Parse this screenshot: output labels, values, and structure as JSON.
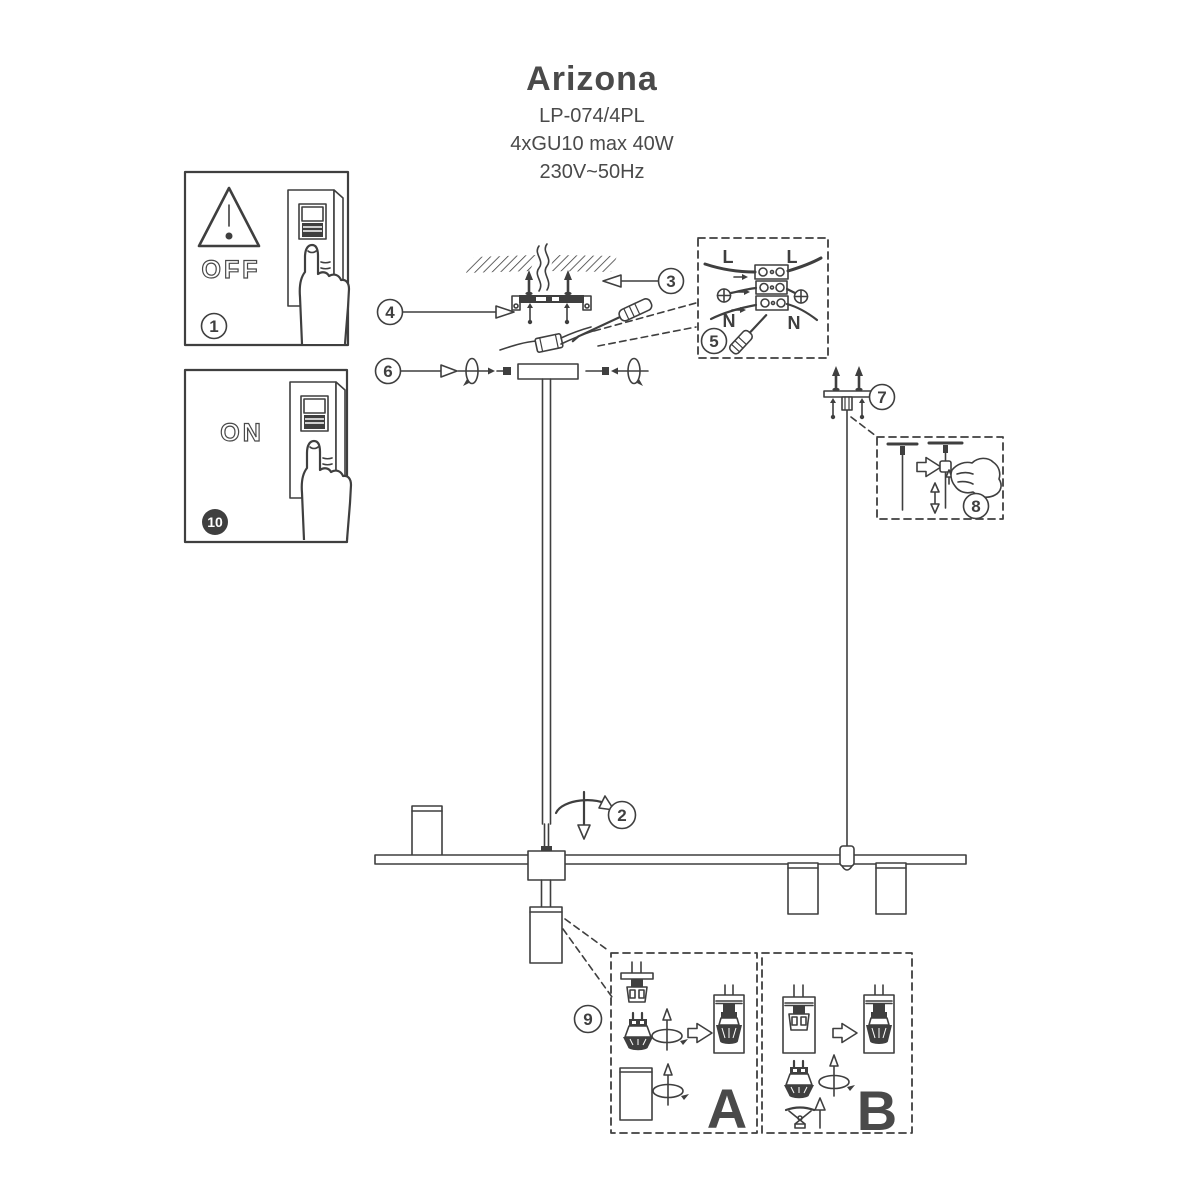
{
  "meta": {
    "ink_color": "#3f3f3f",
    "paper_color": "#ffffff"
  },
  "title": {
    "product": "Arizona",
    "model": "LP-074/4PL",
    "lamps": "4xGU10 max 40W",
    "voltage": "230V~50Hz"
  },
  "switch_panels": {
    "off": "OFF",
    "on": "ON"
  },
  "wiring_labels": {
    "live_left": "L",
    "live_right": "L",
    "neutral_left": "N",
    "neutral_right": "N"
  },
  "variant_labels": {
    "a": "A",
    "b": "B"
  },
  "steps": {
    "n1": "1",
    "n2": "2",
    "n3": "3",
    "n4": "4",
    "n5": "5",
    "n6": "6",
    "n7": "7",
    "n8": "8",
    "n9": "9",
    "n10": "10"
  },
  "icons": {
    "warning": "triangle-exclamation",
    "light_switch": "rocker-switch",
    "pressing_hand": "hand-pointing-finger",
    "ceiling": "hatched-slab",
    "mounting_bracket": "bar-with-flanges",
    "screw": "screw-with-arrow-tip",
    "screwdriver": "flat-screwdriver",
    "terminal_block": "three-row-connector",
    "earth_screw": "circle-with-cross",
    "rotation": "ellipse-with-arrow",
    "canopy": "ceiling-cup",
    "wire_grip": "cable-adjuster",
    "adjusting_hand": "pinching-hand",
    "block_arrow": "open-right-arrow",
    "gu10_bulb": "reflector-lamp",
    "socket": "lamp-holder",
    "spotlight": "cylinder-shade",
    "retaining_ring": "spring-clip"
  }
}
